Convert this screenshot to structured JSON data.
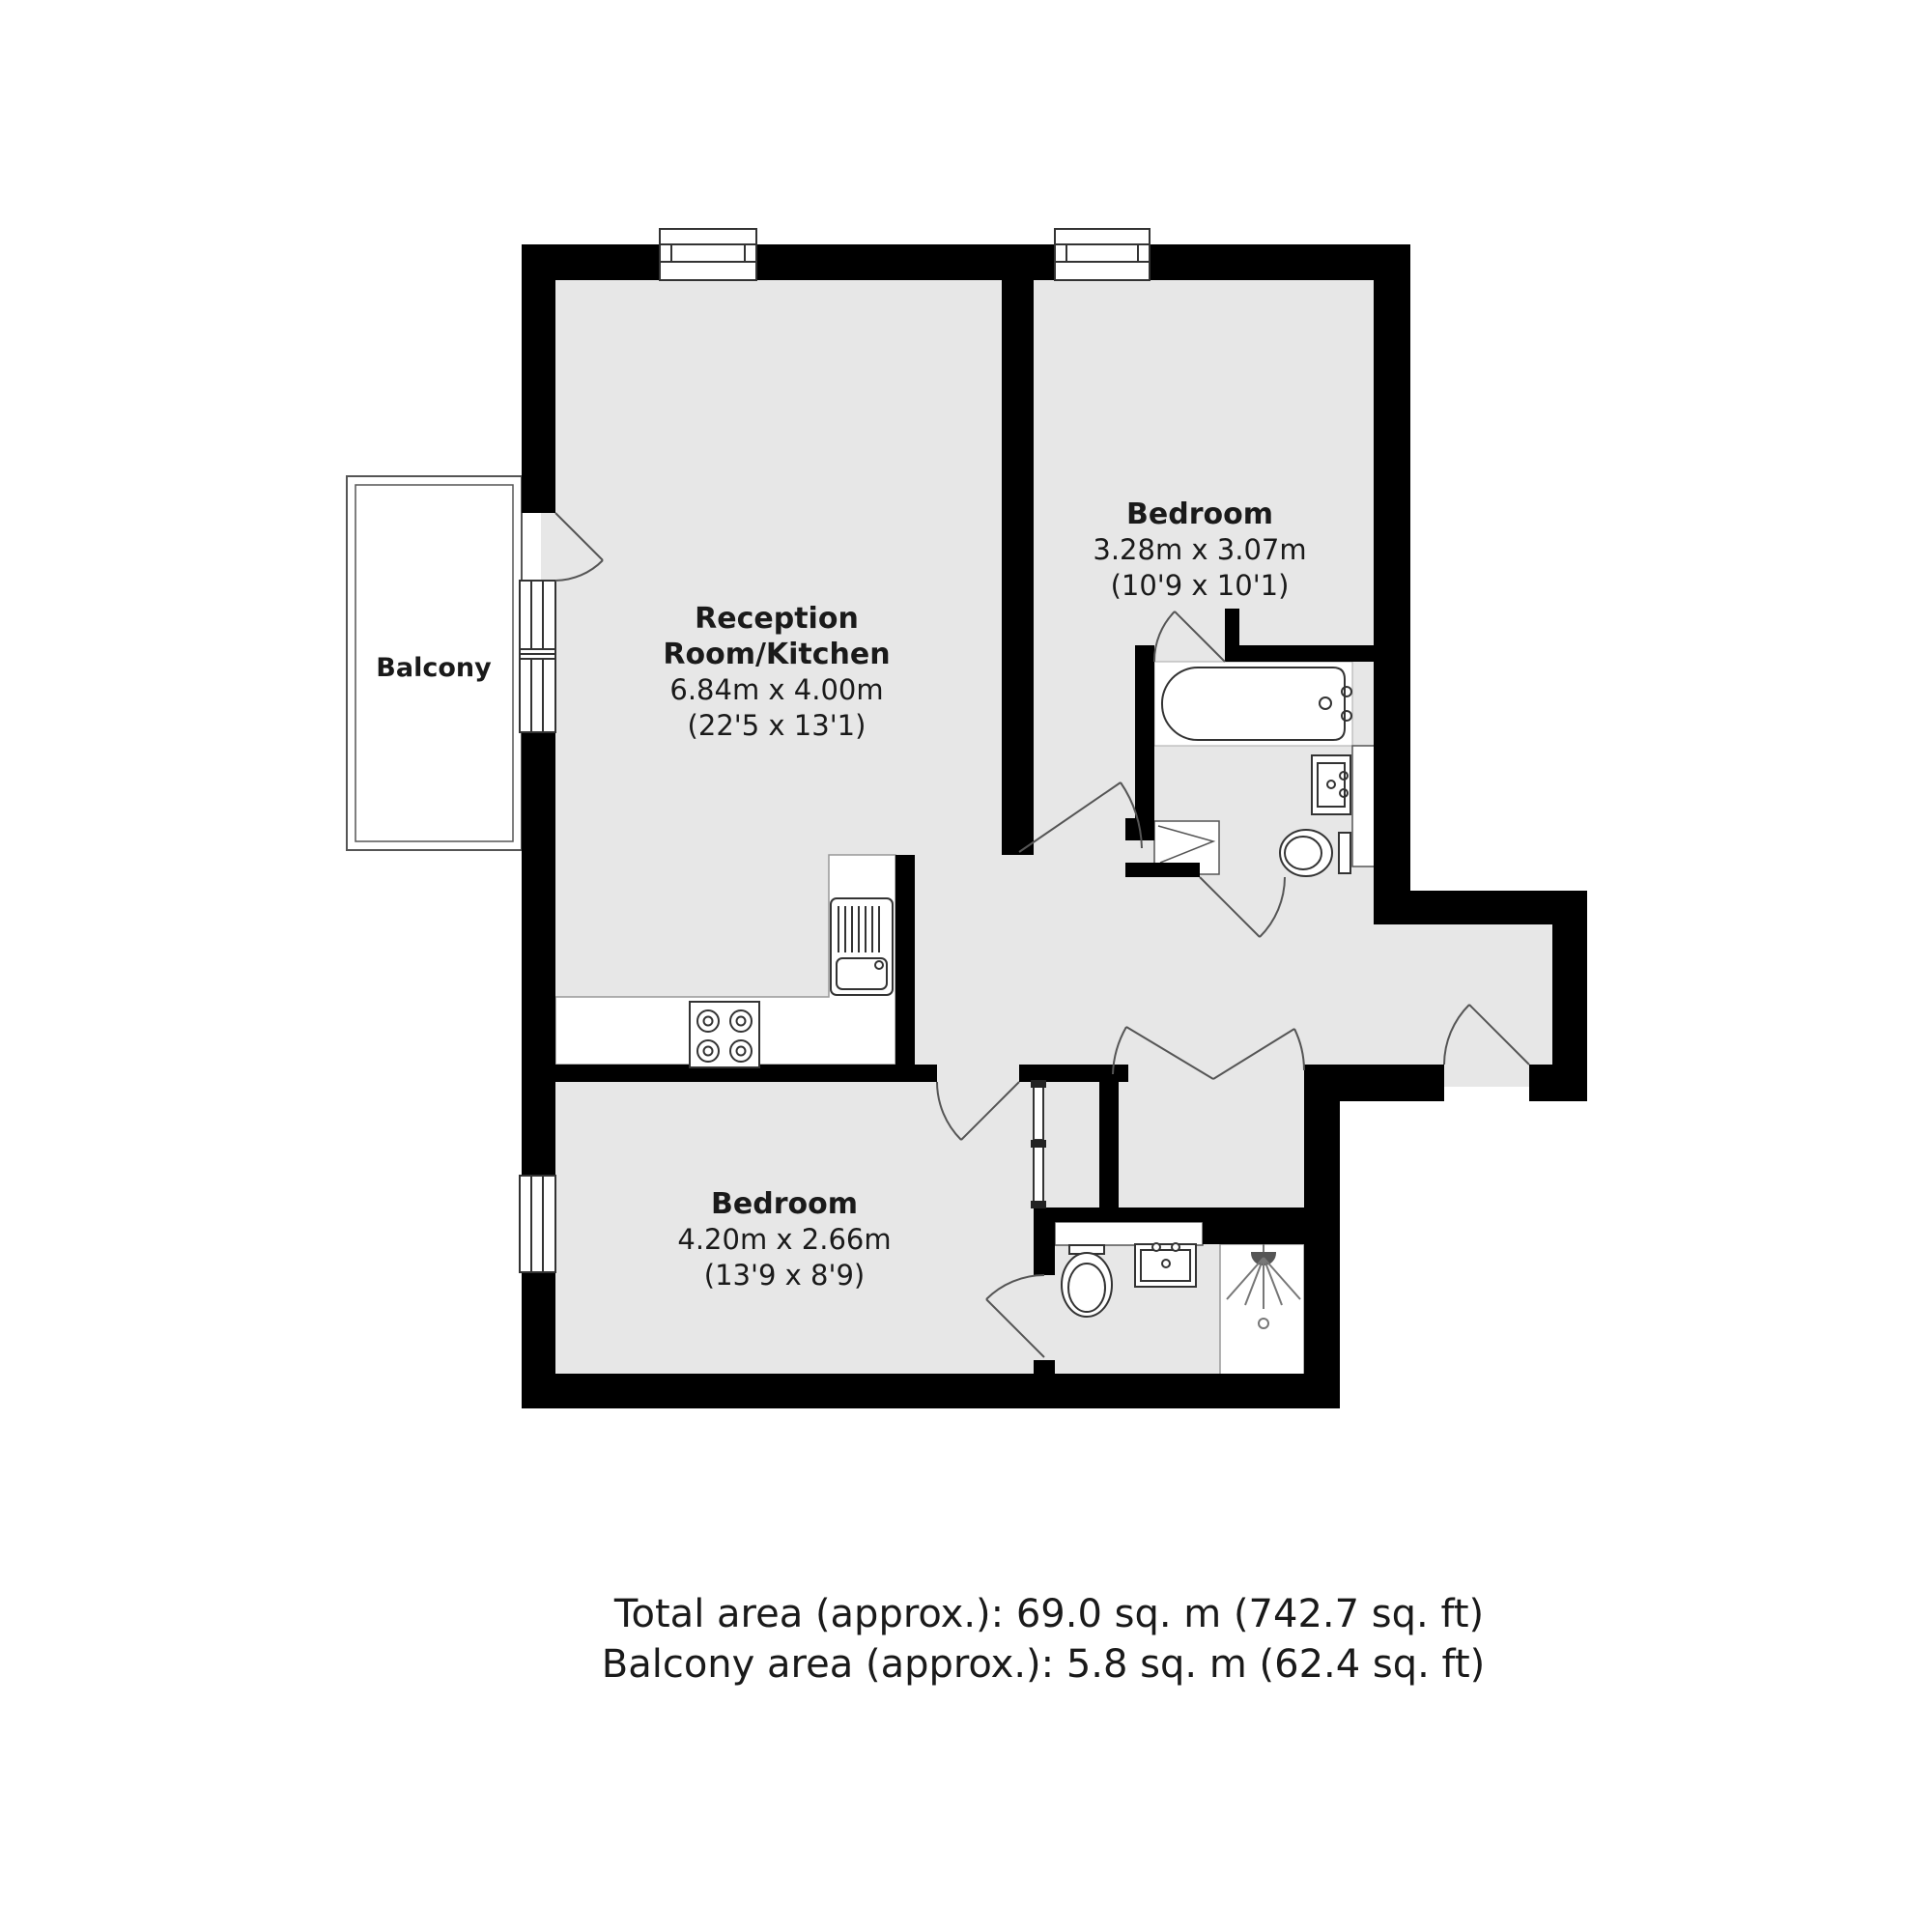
{
  "plan": {
    "colors": {
      "wall": "#000000",
      "floor": "#e7e7e7",
      "fixture_stroke": "#333333",
      "door_line": "#555555"
    },
    "balcony": {
      "label": "Balcony"
    },
    "reception": {
      "name_line1": "Reception",
      "name_line2": "Room/Kitchen",
      "size_metric": "6.84m x 4.00m",
      "size_imperial": "(22'5 x 13'1)"
    },
    "bedroom_top": {
      "name": "Bedroom",
      "size_metric": "3.28m x 3.07m",
      "size_imperial": "(10'9 x 10'1)"
    },
    "bedroom_bottom": {
      "name": "Bedroom",
      "size_metric": "4.20m x 2.66m",
      "size_imperial": "(13'9 x 8'9)"
    }
  },
  "footer": {
    "total_area": "Total area (approx.): 69.0 sq. m (742.7 sq. ft)",
    "balcony_area": "Balcony area (approx.): 5.8 sq. m (62.4 sq. ft)"
  }
}
